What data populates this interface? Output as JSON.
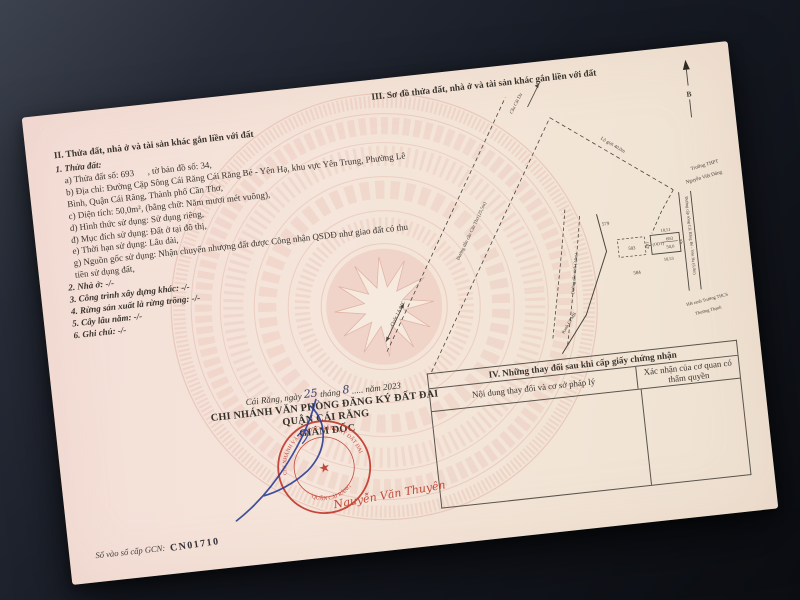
{
  "section_2": {
    "title": "II. Thửa đất, nhà ở và tài sản khác gắn liền với đất",
    "subtitle": "1. Thửa đất:",
    "fields": [
      "a) Thửa đất số: 693      , tờ bản đồ số: 34,",
      "b) Địa chỉ: Đường Cặp Sông Cái Răng Cái Răng Bé - Yên Hạ, khu vực Yên Trung, Phường Lê Bình, Quận Cái Răng, Thành phố Cần Thơ,",
      "c) Diện tích: 50,0m², (bằng chữ: Năm mươi mét vuông),",
      "d) Hình thức sử dụng: Sử dụng riêng,",
      "đ) Mục đích sử dụng: Đất ở tại đô thị,",
      "e) Thời hạn sử dụng: Lâu dài,",
      "g) Nguồn gốc sử dụng: Nhận chuyển nhượng đất được Công nhận QSDĐ như giao đất có thu tiền sử dụng đất,"
    ],
    "items": [
      "2. Nhà ở: -/-",
      "3. Công trình xây dựng khác: -/-",
      "4. Rừng sản xuất là rừng trồng: -/-",
      "5. Cây lâu năm: -/-",
      "6. Ghi chú: -/-"
    ]
  },
  "section_3": {
    "title": "III. Sơ đồ thửa đất, nhà ở và tài sản khác gắn liền với đất",
    "diagram": {
      "north_label": "B",
      "bridge_label": "Cầu Cái Da",
      "bridge_road_label": "Đường dẫn cầu Cần Thơ (25,5m)",
      "highway_label": "Quốc Lộ 61C",
      "corridor_label": "Lộ giới 40,0m",
      "school_1_line_1": "Trường THPT",
      "school_1_line_2": "Nguyễn Việt Dũng",
      "riverside_road_label": "Đường cặp sông Cái Răng Bé - Yên Hạ (6,0m)",
      "local_road_label": "Đường dân sinh (3,0m)",
      "clearance_boundary_label": "Ranh GPMB",
      "school_2_line_1": "Hết ranh Trường THCS",
      "school_2_line_2": "Thường Thạnh",
      "plot": {
        "number": "693",
        "area": "50,0",
        "land_type": "(ODT)",
        "edge_top": "10,51",
        "edge_bottom": "10,53",
        "edge_left": "4,81",
        "edge_right": "4,6"
      },
      "adjacent_plots": {
        "north_west": "579",
        "west": "583",
        "south": "584"
      }
    }
  },
  "section_4": {
    "title": "IV. Những thay đổi sau khi cấp giấy chứng nhận",
    "column_1": "Nội dung thay đổi và cơ sở pháp lý",
    "column_2": "Xác nhận của cơ quan có thẩm quyền"
  },
  "signing": {
    "date_prefix": "Cái Răng, ngày",
    "date_day": "25",
    "date_mid": "tháng",
    "date_month": "8",
    "date_suffix": "..... năm 2023",
    "office_line_1": "CHI NHÁNH VĂN PHÒNG ĐĂNG KÝ ĐẤT ĐAI",
    "office_line_2": "QUẬN CÁI RĂNG",
    "signer_title": "GIÁM ĐỐC",
    "signer_name": "Nguyễn Văn Thuyên",
    "stamp_arc_top": "CHI NHÁNH VĂN PHÒNG ĐĂNG KÝ ĐẤT ĐAI",
    "stamp_arc_bottom": "QUẬN CÁI RĂNG",
    "stamp_center": "★",
    "ink_color": "#2c3e94",
    "stamp_color": "#c23a2e"
  },
  "footer": {
    "serial_label": "Số vào sổ cấp GCN:",
    "serial_value": "CN01710"
  }
}
